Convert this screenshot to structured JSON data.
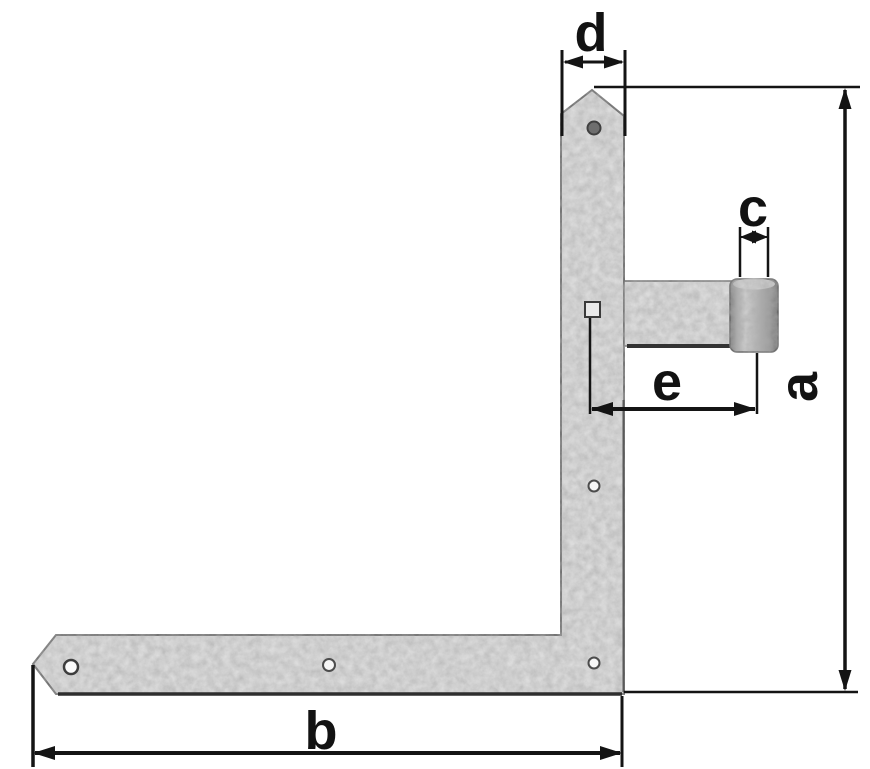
{
  "drawing": {
    "description": "Technical dimension drawing of an L-shaped corner gate hinge (angle band) with hinge barrel",
    "labels": {
      "a": "a",
      "b": "b",
      "c": "c",
      "d": "d",
      "e": "e"
    },
    "dimensions": [
      {
        "label": "d",
        "orientation": "horizontal",
        "refers_to": "width of vertical strap (top)"
      },
      {
        "label": "c",
        "orientation": "horizontal",
        "refers_to": "hinge barrel pin diameter"
      },
      {
        "label": "e",
        "orientation": "horizontal",
        "refers_to": "distance from strap to barrel axis"
      },
      {
        "label": "a",
        "orientation": "vertical",
        "refers_to": "overall height of hinge"
      },
      {
        "label": "b",
        "orientation": "horizontal",
        "refers_to": "overall width of hinge"
      }
    ],
    "parts": {
      "vertical_strap": "vertical-strap",
      "horizontal_strap": "horizontal-strap",
      "hinge_arm": "hinge-arm",
      "hinge_barrel": "hinge-barrel"
    },
    "colors": {
      "background": "#ffffff",
      "line": "#141414",
      "metal": "#dcdcdc",
      "metal_edge": "#6f6f6f",
      "barrel_shadow": "#7e7e7e"
    }
  }
}
